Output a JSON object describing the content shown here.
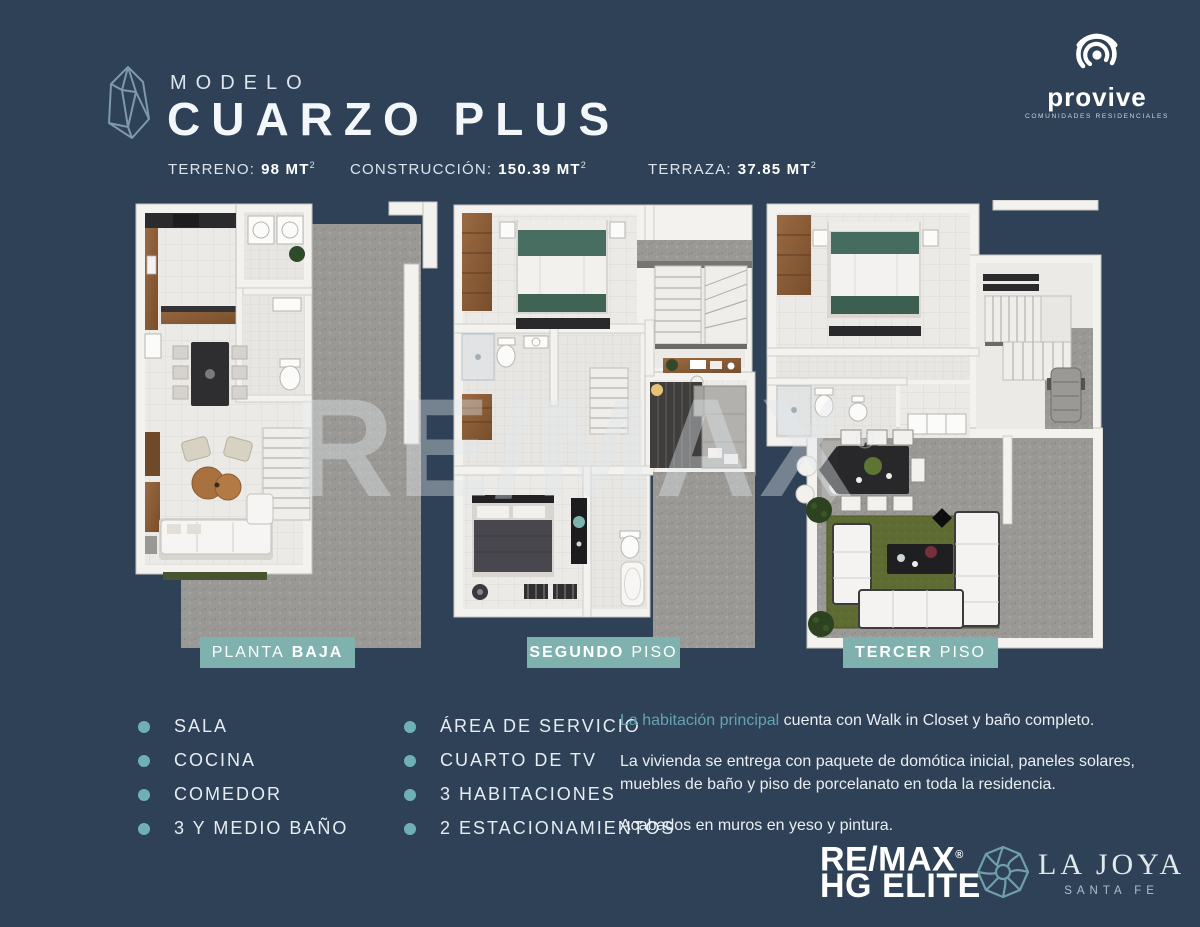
{
  "header": {
    "model_label": "MODELO",
    "model_name": "CUARZO PLUS",
    "specs": [
      {
        "label": "TERRENO:",
        "value": "98 MT",
        "sup": "2"
      },
      {
        "label": "CONSTRUCCIÓN:",
        "value": "150.39 MT",
        "sup": "2"
      },
      {
        "label": "TERRAZA:",
        "value": "37.85 MT",
        "sup": "2"
      }
    ]
  },
  "brand_top": {
    "name": "provive",
    "tagline": "COMUNIDADES RESIDENCIALES"
  },
  "plans": [
    {
      "word1": "PLANTA",
      "word2": "BAJA"
    },
    {
      "word1": "SEGUNDO",
      "word2": "PISO"
    },
    {
      "word1": "TERCER",
      "word2": "PISO"
    }
  ],
  "watermark": {
    "text": "RE/MAX",
    "registered": "®"
  },
  "features": {
    "col1": [
      "SALA",
      "COCINA",
      "COMEDOR",
      "3 Y MEDIO BAÑO"
    ],
    "col2": [
      "ÁREA DE SERVICIO",
      "CUARTO DE TV",
      "3 HABITACIONES",
      "2 ESTACIONAMIENTOS"
    ]
  },
  "notes": {
    "p1_highlight": "La habitación principal",
    "p1_rest": " cuenta con Walk in Closet y baño completo.",
    "p2": "La vivienda se entrega con paquete de domótica inicial, paneles solares, muebles de baño y piso de porcelanato en toda la residencia.",
    "p3": "Acabados en muros en yeso y pintura."
  },
  "brand_bottom": {
    "remax_name": "RE/MAX",
    "remax_reg": "®",
    "remax_sub": "HG ELITE",
    "lajoya_name": "LA JOYA",
    "lajoya_sub": "SANTA FE"
  },
  "colors": {
    "background": "#2e4156",
    "badge": "#7fb2ae",
    "accent": "#67a2b2",
    "bullet": "#6fb0b6"
  }
}
